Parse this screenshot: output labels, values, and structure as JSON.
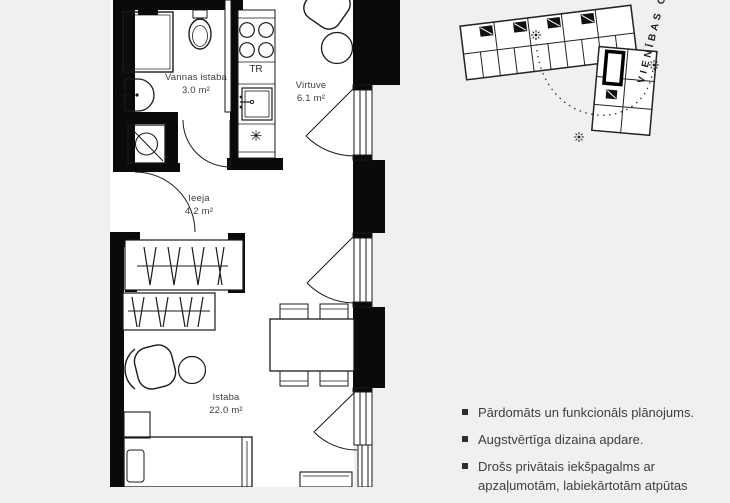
{
  "colors": {
    "background": "#f0f0f0",
    "wall": "#0a0a0a",
    "line": "#1a1a1a",
    "text": "#3d3d3d"
  },
  "floor_plan": {
    "rooms": [
      {
        "name": "Vannas istaba",
        "area": "3.0 m²"
      },
      {
        "name": "Virtuve",
        "area": "6.1 m²"
      },
      {
        "name": "Ieeja",
        "area": "4.2 m²"
      },
      {
        "name": "Istaba",
        "area": "22.0 m²"
      }
    ],
    "appliance_labels": {
      "towel_dryer": "TR",
      "fridge_symbol": "✳"
    }
  },
  "site_plan": {
    "street": "VIENĪBAS GAT"
  },
  "highlights": [
    "Pārdomāts un funkcionāls plānojums.",
    "Augstvērtīga dizaina apdare.",
    "Drošs privātais iekšpagalms ar apzaļumotām, labiekārtotām atpūtas"
  ]
}
